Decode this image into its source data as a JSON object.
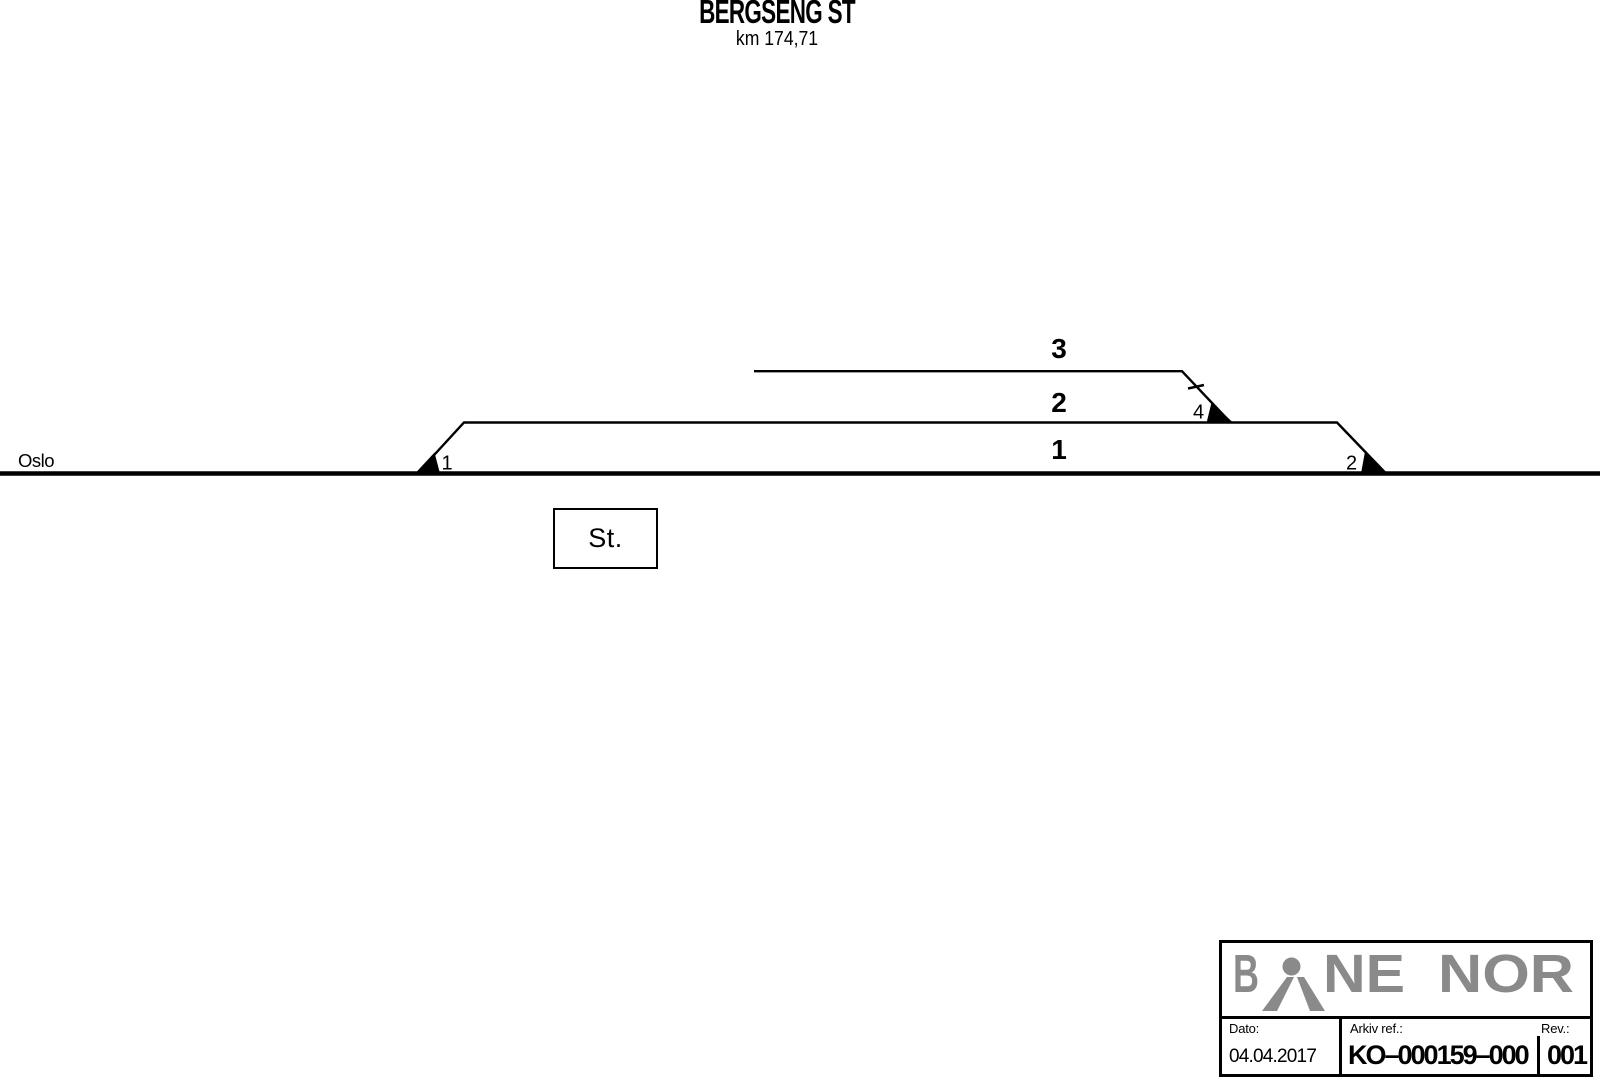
{
  "header": {
    "station_name": "BERGSENG ST",
    "km_label": "km 174,71"
  },
  "diagram": {
    "direction_label": "Oslo",
    "station_box_label": "St.",
    "tracks": [
      {
        "id": "track-1",
        "label": "1"
      },
      {
        "id": "track-2",
        "label": "2"
      },
      {
        "id": "track-3",
        "label": "3"
      }
    ],
    "switches": [
      {
        "id": "switch-1",
        "label": "1"
      },
      {
        "id": "switch-2",
        "label": "2"
      },
      {
        "id": "switch-4",
        "label": "4"
      }
    ]
  },
  "title_block": {
    "logo": {
      "letter_b": "B",
      "letters_ne": "NE",
      "letters_nor": "NOR",
      "color": "#8a8a8a"
    },
    "fields": {
      "dato_label": "Dato:",
      "dato_value": "04.04.2017",
      "arkiv_label": "Arkiv ref.:",
      "arkiv_value": "KO–000159–000",
      "rev_label": "Rev.:",
      "rev_value": "001"
    }
  },
  "colors": {
    "ink": "#000000",
    "background": "#ffffff",
    "logo_gray": "#8a8a8a"
  }
}
